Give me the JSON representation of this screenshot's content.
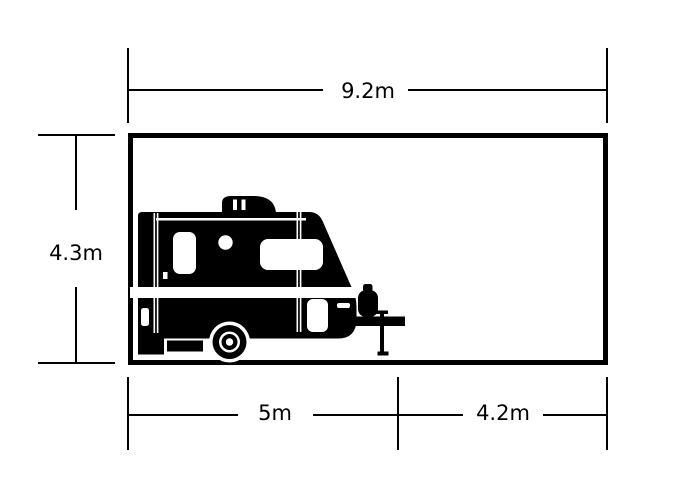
{
  "colors": {
    "line": "#000000",
    "background": "#ffffff"
  },
  "dimensions": {
    "top_width": "9.2m",
    "left_height": "4.3m",
    "bottom_left": "5m",
    "bottom_right": "4.2m"
  },
  "icons": {
    "vehicle": "caravan-icon"
  }
}
